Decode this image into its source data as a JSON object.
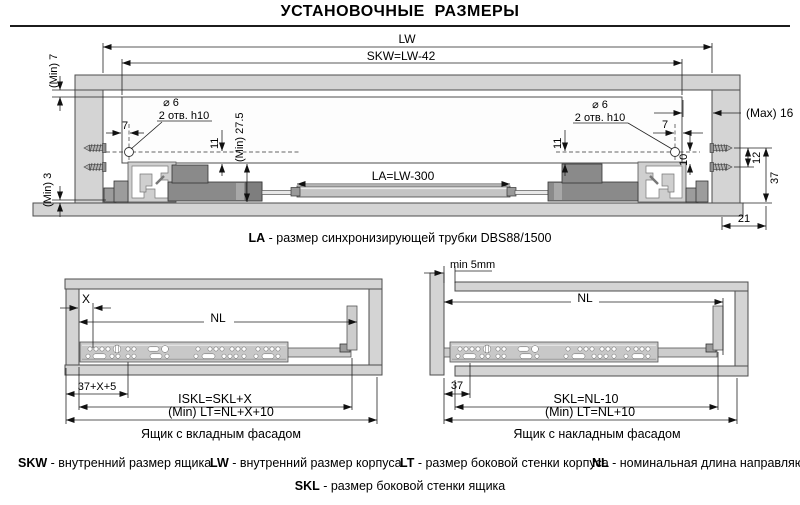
{
  "title": "УСТАНОВОЧНЫЕ  РАЗМЕРЫ",
  "main": {
    "lw": "LW",
    "skw": "SKW=LW-42",
    "min7": "(Min) 7",
    "min3": "(Min) 3",
    "max16": "(Max) 16",
    "hole_dia": "⌀ 6",
    "hole_note": "2 отв. h10",
    "d7": "7",
    "d11": "11",
    "d10": "10",
    "d12": "12",
    "d37": "37",
    "d21": "21",
    "min275": "(Min) 27.5",
    "la": "LA=LW-300",
    "caption_term": "LA",
    "caption_text": " - размер синхронизирующей трубки DBS88/1500"
  },
  "left": {
    "x": "X",
    "nl": "NL",
    "offset": "37+X+5",
    "iskl": "ISKL=SKL+X",
    "lt": "(Min) LT=NL+X+10",
    "caption": "Ящик с вкладным фасадом"
  },
  "right": {
    "min5": "min 5mm",
    "nl": "NL",
    "offset": "37",
    "skl": "SKL=NL-10",
    "lt": "(Min) LT=NL+10",
    "caption": "Ящик с накладным фасадом"
  },
  "legend": {
    "items": [
      {
        "term": "SKW",
        "desc": " - внутренний размер ящика"
      },
      {
        "term": "LW",
        "desc": " - внутренний размер корпуса"
      },
      {
        "term": "LT",
        "desc": " - размер боковой стенки корпуса"
      },
      {
        "term": "NL",
        "desc": " - номинальная длина направляющей"
      }
    ],
    "row2_term": "SKL",
    "row2_desc": " - размер боковой стенки ящика"
  },
  "colors": {
    "panel": "#d4d4d4",
    "rail": "#c8c8c8",
    "dark": "#8a8a8a",
    "line": "#222222"
  }
}
